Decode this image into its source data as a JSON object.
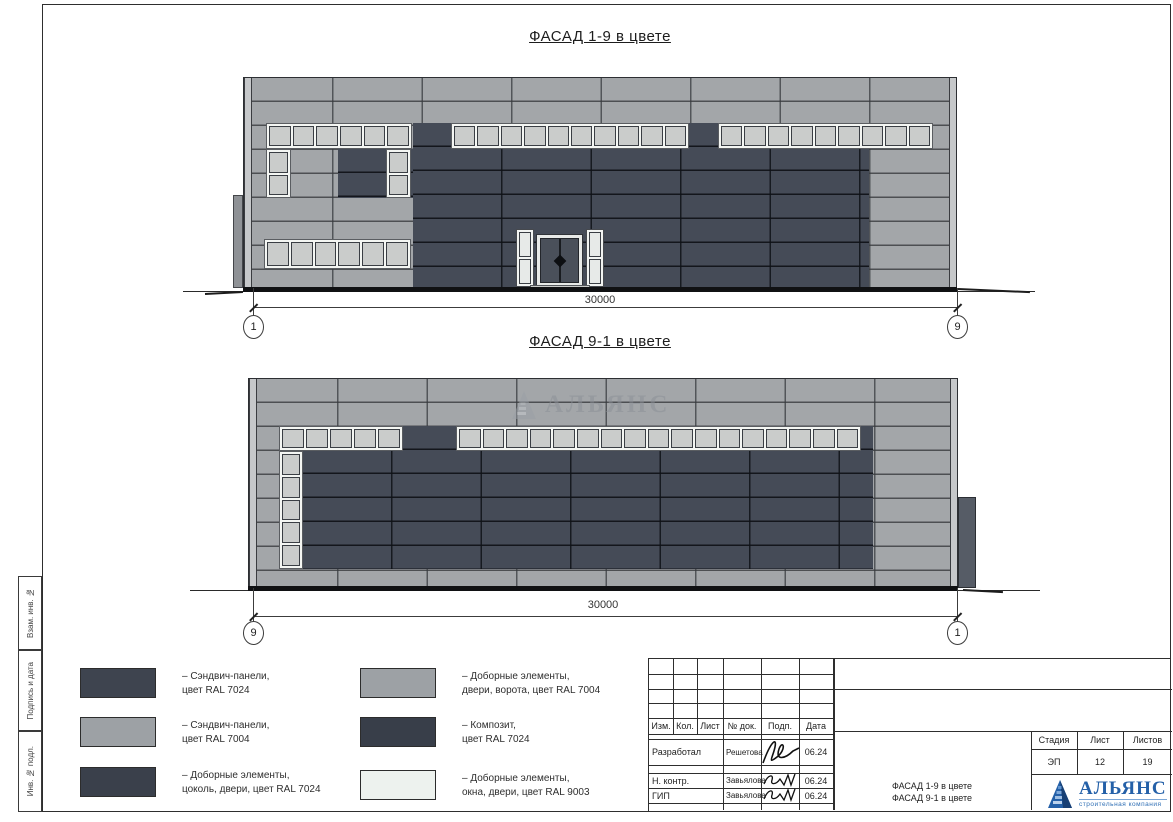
{
  "facade1": {
    "title": "ФАСАД 1-9 в цвете",
    "dimension": "30000",
    "grid_left": "1",
    "grid_right": "9"
  },
  "facade2": {
    "title": "ФАСАД 9-1 в цвете",
    "dimension": "30000",
    "grid_left": "9",
    "grid_right": "1",
    "watermark_text": "АЛЬЯНС"
  },
  "legend": {
    "items": [
      {
        "line1": "– Сэндвич-панели,",
        "line2": "цвет RAL 7024",
        "color": "#3e444f"
      },
      {
        "line1": "– Сэндвич-панели,",
        "line2": "цвет RAL 7004",
        "color": "#9da1a5"
      },
      {
        "line1": "– Доборные элементы,",
        "line2": "цоколь, двери, цвет RAL 7024",
        "color": "#3a404b"
      },
      {
        "line1": "– Доборные элементы,",
        "line2": "двери, ворота, цвет RAL 7004",
        "color": "#9da1a5"
      },
      {
        "line1": "– Композит,",
        "line2": "цвет RAL 7024",
        "color": "#383e49"
      },
      {
        "line1": "– Доборные элементы,",
        "line2": "окна, двери, цвет RAL 9003",
        "color": "#edf2ee"
      }
    ]
  },
  "titleblock": {
    "header_cols": [
      "Изм.",
      "Кол.",
      "Лист",
      "№ док.",
      "Подп.",
      "Дата"
    ],
    "rows": [
      {
        "role": "Разработал",
        "name": "Решетова",
        "date": "06.24"
      },
      {
        "role": "Н. контр.",
        "name": "Завьялова",
        "date": "06.24"
      },
      {
        "role": "ГИП",
        "name": "Завьялова",
        "date": "06.24"
      }
    ],
    "stage_label": "Стадия",
    "sheet_label": "Лист",
    "sheets_label": "Листов",
    "stage": "ЭП",
    "sheet": "12",
    "sheets": "19",
    "doc_title_line1": "ФАСАД 1-9 в цвете",
    "doc_title_line2": "ФАСАД 9-1 в цвете",
    "logo": {
      "name": "АЛЬЯНС",
      "subtitle": "строительная компания"
    }
  },
  "side_labels": [
    "Взам. инв. №",
    "Подпись и дата",
    "Инв. № подл."
  ],
  "colors": {
    "ral7024": "#3f4550",
    "ral7004": "#a1a4a8",
    "ral9003": "#eef3ee",
    "logo_blue": "#2460a8"
  }
}
